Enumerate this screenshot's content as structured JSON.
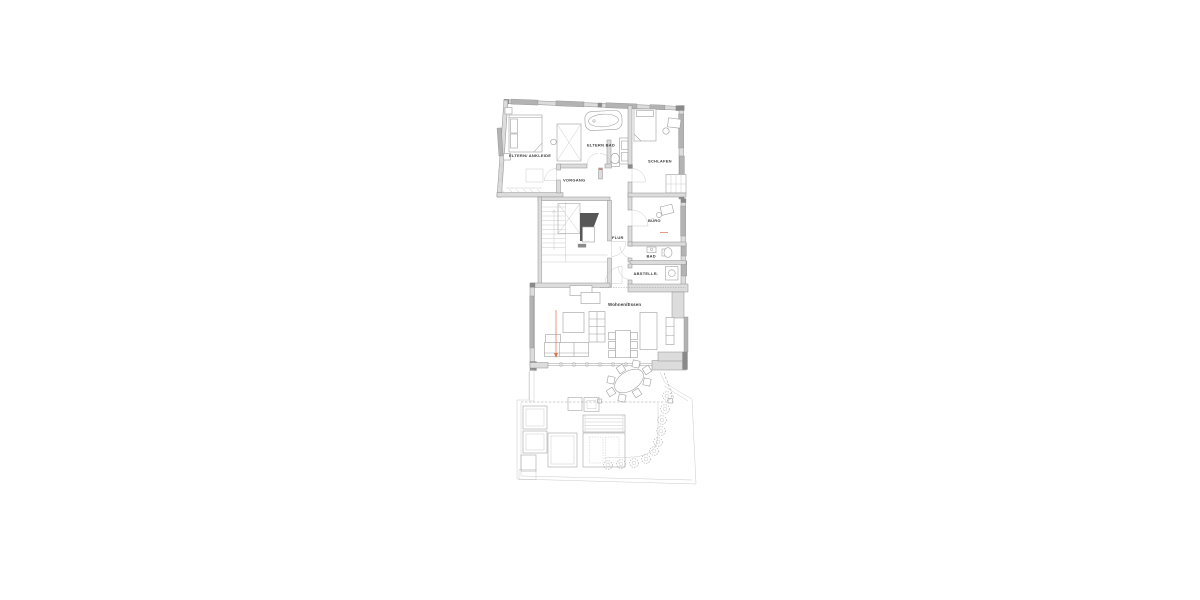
{
  "plan": {
    "rooms": {
      "eltern_ankleide": "ELTERN/ ANKLEIDE",
      "eltern_bad": "ELTERN BAD",
      "schlafen": "SCHLAFEN",
      "vorgang": "VORGANG",
      "buero": "BÜRO",
      "flur": "FLUR",
      "bad": "BAD",
      "abstellraum": "ABSTELLR.",
      "wohnen_essen": "Wohnen/Essen"
    },
    "colors": {
      "wall_fill": "#dcdcdc",
      "wall_stroke": "#8f8f8f",
      "wall_dark": "#8a8a8a",
      "window_fill": "#b3b3b3",
      "furn": "#9f9f9f",
      "furn_light": "#c4c4c4",
      "core_dark": "#575757",
      "accent": "#d9734f",
      "text": "#3a3a3a",
      "background": "#ffffff"
    }
  }
}
